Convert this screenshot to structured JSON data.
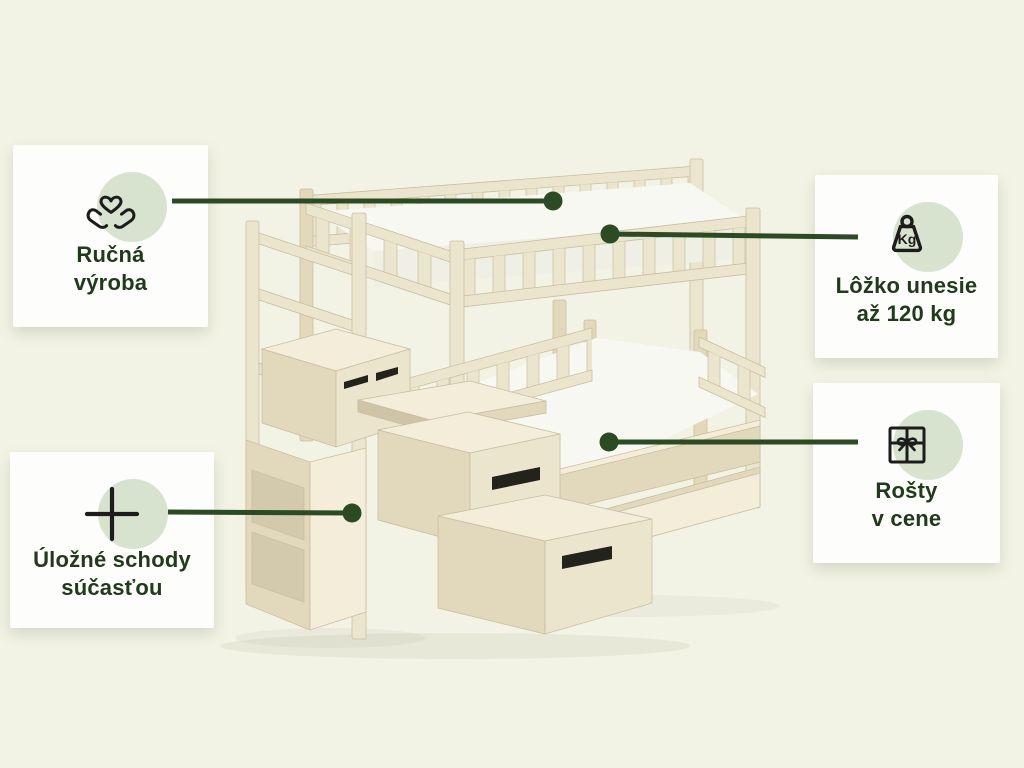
{
  "colors": {
    "background": "#f2f3e4",
    "card": "#fdfdfc",
    "accent_green": "#2c4a23",
    "text_green": "#213a1c",
    "circle_green": "#d7e3cf",
    "wood_light": "#ece5ce",
    "mattress": "#f8f8f3"
  },
  "illustration": {
    "icon": "bunk-bed-with-storage-stairs-illustration"
  },
  "cards": [
    {
      "icon": "hands-holding-heart-icon",
      "lines": [
        "Ručná",
        "výroba"
      ]
    },
    {
      "icon": "plus-icon",
      "lines": [
        "Úložné schody",
        "súčasťou"
      ]
    },
    {
      "icon": "weight-kg-icon",
      "icon_label": "Kg",
      "lines": [
        "Lôžko unesie",
        "až 120 kg"
      ]
    },
    {
      "icon": "gift-icon",
      "lines": [
        "Rošty",
        "v cene"
      ]
    }
  ]
}
